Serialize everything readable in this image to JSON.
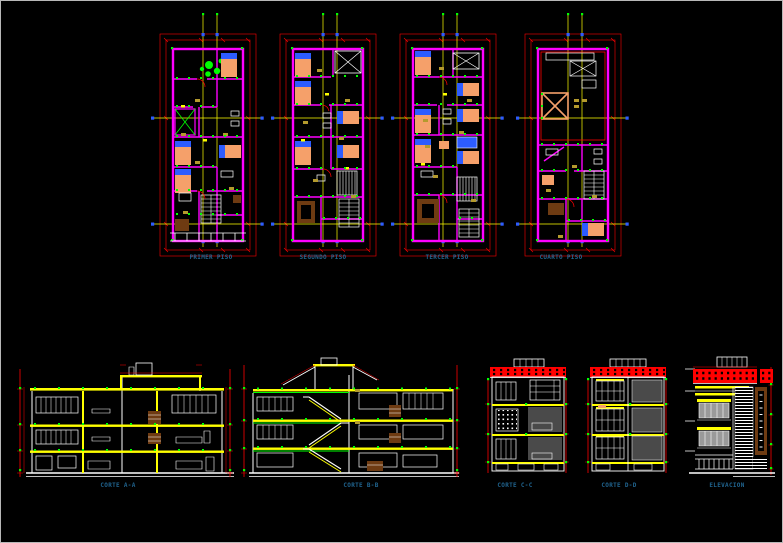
{
  "sheet": {
    "background": "#000000",
    "border": "#b8b8b8"
  },
  "palette": {
    "red": "#ff0000",
    "magenta": "#ff00ff",
    "yellow": "#ffff00",
    "green": "#00ff00",
    "cyan": "#00ffff",
    "blue": "#2d5cff",
    "white": "#ffffff",
    "peach": "#f5a06a",
    "brown": "#6e3b12",
    "khaki": "#b49a2d",
    "gray": "#9a9a9a",
    "darkgray": "#4a4a4a",
    "labelblue": "#20648f",
    "black": "#000000"
  },
  "plans": [
    {
      "label": "PRIMER PISO"
    },
    {
      "label": "SEGUNDO PISO"
    },
    {
      "label": "TERCER PISO"
    },
    {
      "label": "CUARTO PISO"
    }
  ],
  "sections": [
    {
      "label": "CORTE A-A"
    },
    {
      "label": "CORTE B-B"
    },
    {
      "label": "CORTE C-C"
    },
    {
      "label": "CORTE D-D"
    },
    {
      "label": "ELEVACION"
    }
  ]
}
